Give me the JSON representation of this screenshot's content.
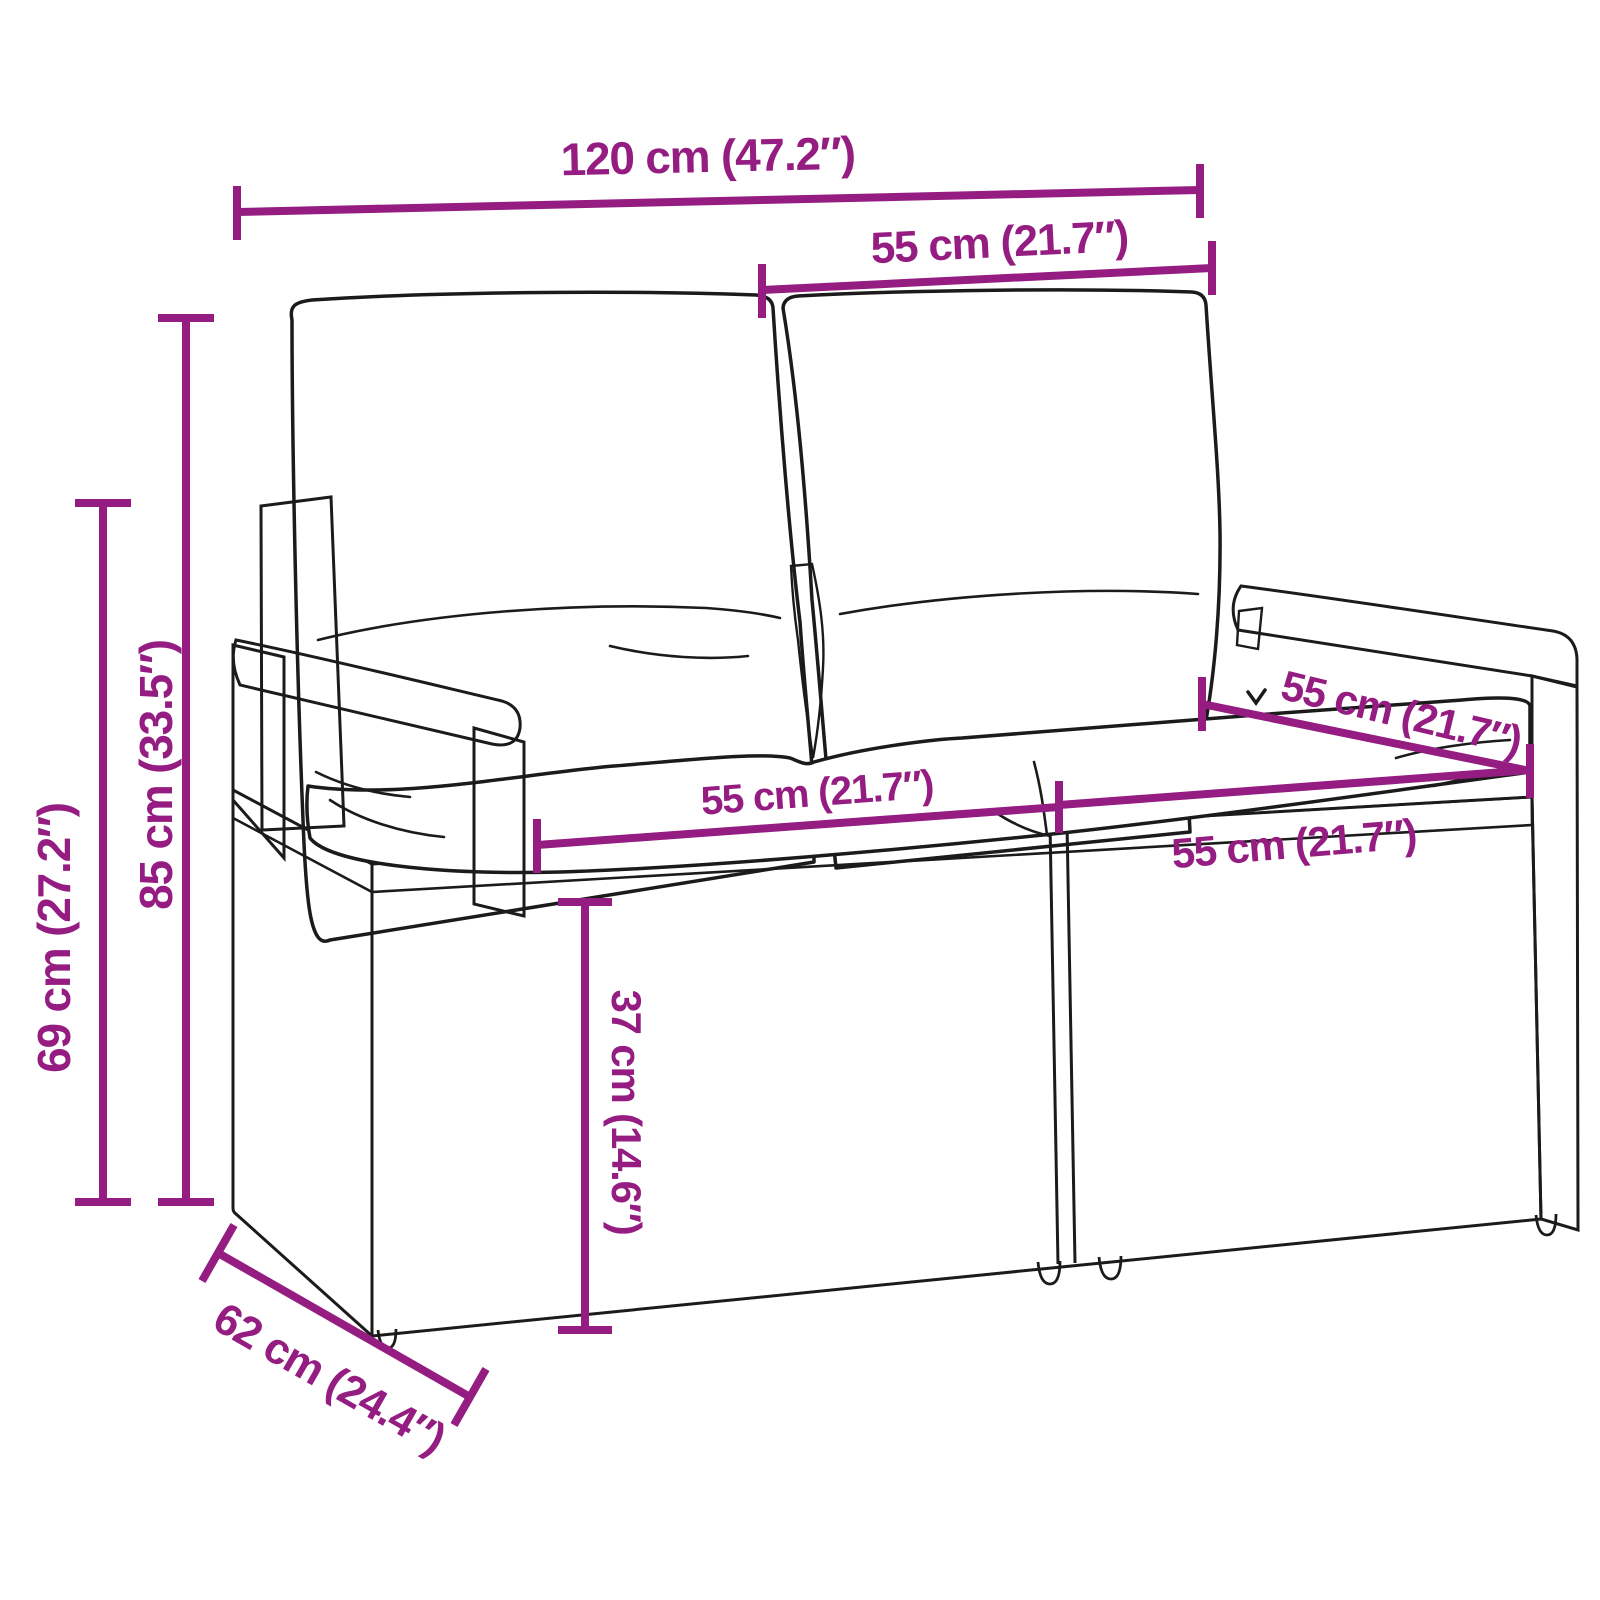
{
  "colors": {
    "dimension_accent": "#951d82",
    "line_art": "#1b1b1b",
    "background": "#ffffff"
  },
  "dimensions": {
    "overall_width": {
      "label": "120 cm (47.2″)"
    },
    "backrest_width": {
      "label": "55 cm (21.7″)"
    },
    "total_height": {
      "label": "85 cm (33.5″)"
    },
    "armrest_height": {
      "label": "69 cm (27.2″)"
    },
    "seat_width_left": {
      "label": "55 cm (21.7″)"
    },
    "seat_width_right": {
      "label": "55 cm (21.7″)"
    },
    "seat_depth": {
      "label": "55 cm (21.7″)"
    },
    "seat_height": {
      "label": "37 cm (14.6″)"
    },
    "overall_depth": {
      "label": "62 cm (24.4″)"
    }
  }
}
